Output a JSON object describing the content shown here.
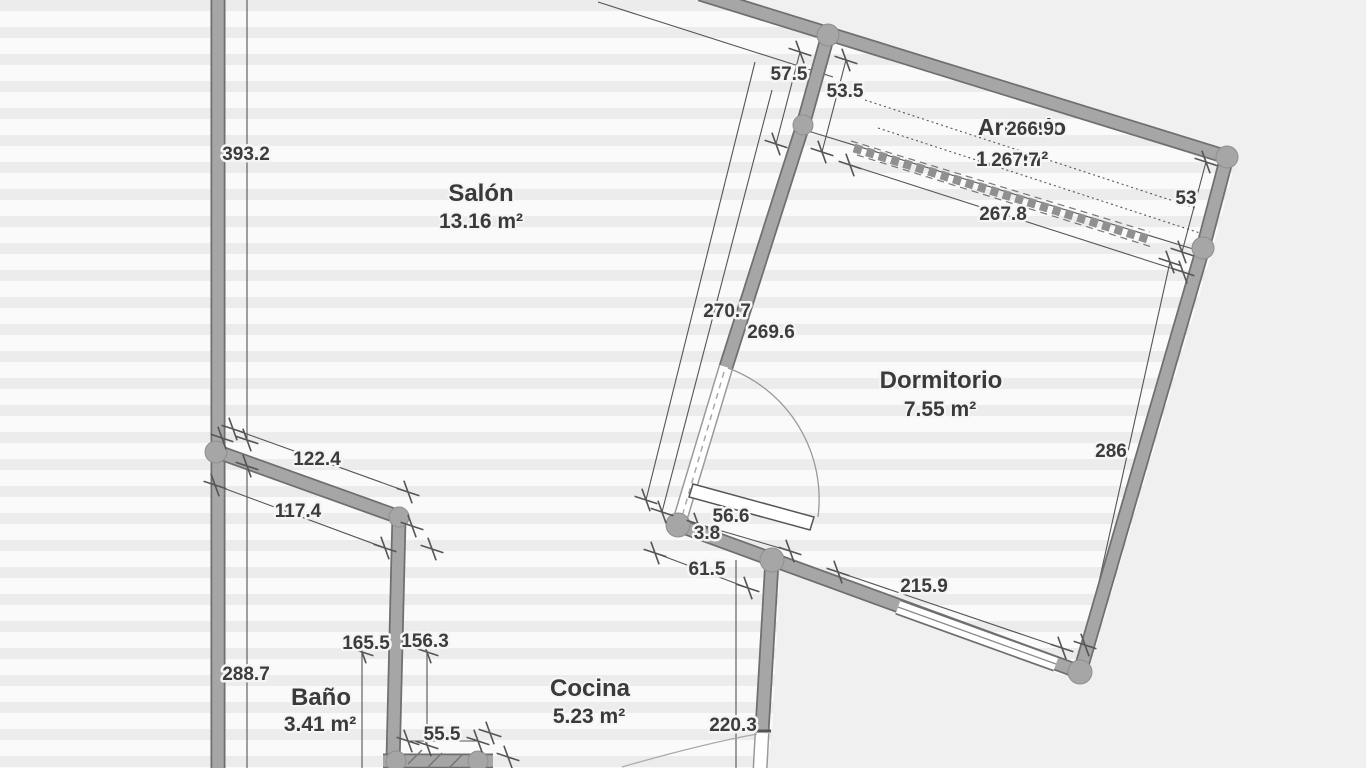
{
  "plan": {
    "rooms": [
      {
        "name": "Salón",
        "area": "13.16 m²"
      },
      {
        "name": "Dormitorio",
        "area": "7.55 m²"
      },
      {
        "name": "Baño",
        "area": "3.41 m²"
      },
      {
        "name": "Cocina",
        "area": "5.23 m²"
      },
      {
        "name": "Armario",
        "area": "1.67 m²"
      }
    ],
    "dimensions": {
      "d393_2": "393.2",
      "d288_7": "288.7",
      "d122_4": "122.4",
      "d117_4": "117.4",
      "d165_5": "165.5",
      "d156_3": "156.3",
      "d55_5": "55.5",
      "d220_3": "220.3",
      "d57_5": "57.5",
      "d53_5": "53.5",
      "d266_9": "266.9",
      "d267_7": "267.7",
      "d267_8": "267.8",
      "d53": "53",
      "d286": "286",
      "d270_7": "270.7",
      "d269_6": "269.6",
      "d56_6": "56.6",
      "d3_8": "3.8",
      "d61_5": "61.5",
      "d215_9": "215.9"
    },
    "colors": {
      "wall_fill": "#a6a6a6",
      "wall_edge": "#6f6f6f",
      "dim_line": "#555555",
      "exterior": "#f0f0f0",
      "stripe_light": "#fafafa",
      "stripe_dark": "#ececec"
    }
  }
}
